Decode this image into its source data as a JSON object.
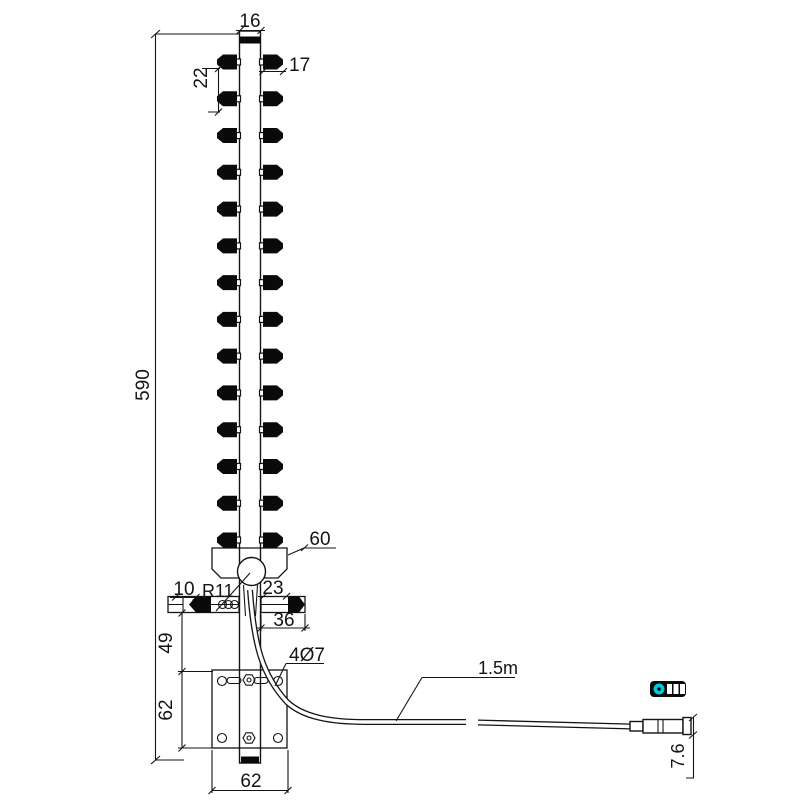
{
  "drawing": {
    "type": "technical-dimension-drawing",
    "subject": "yagi-antenna-with-mounting-bracket-and-coax-cable",
    "background": "#ffffff",
    "line_color": "#141414",
    "connector_accent_color": "#00c9da",
    "directors": {
      "pairs": 14
    },
    "dimensions": {
      "boom_top_width": "16",
      "first_element_spacing": "22",
      "director_length": "17",
      "boom_length": "590",
      "feed_block_width": "60",
      "reflector_left_offset": "10",
      "balun_radius": "R11",
      "reflector_right_offset": "23",
      "reflector_right_length": "36",
      "bracket_upper_height": "49",
      "mounting_holes": "4Ø7",
      "plate_side_height": "62",
      "plate_width": "62",
      "cable_length": "1.5m",
      "connector_height": "7.6"
    }
  }
}
